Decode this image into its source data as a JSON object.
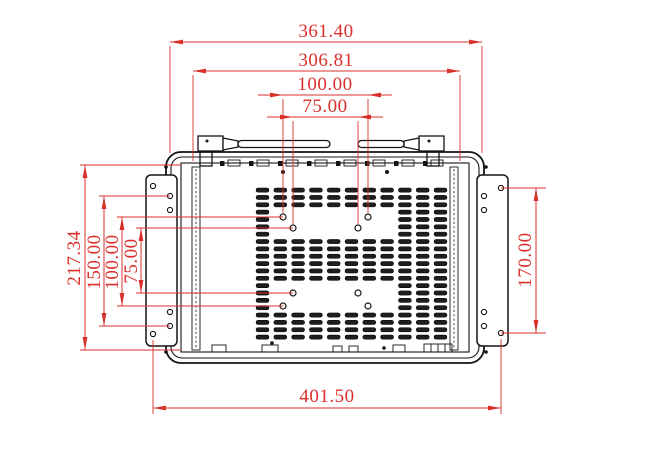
{
  "drawing": {
    "type": "technical-dimension-drawing",
    "subject": "open-frame-monitor-rear-view",
    "colors": {
      "dimension": "#d9302c",
      "outline": "#141414",
      "background": "#ffffff"
    },
    "dims": {
      "overall_width_top": "361.40",
      "top_lug_spacing": "306.81",
      "vesa_width_100": "100.00",
      "vesa_width_75": "75.00",
      "panel_height_left": "217.34",
      "left_bracket_hole_spacing": "150.00",
      "vesa_height_100": "100.00",
      "vesa_height_75": "75.00",
      "right_bracket_hole_spacing": "170.00",
      "overall_width_bottom": "401.50"
    }
  }
}
